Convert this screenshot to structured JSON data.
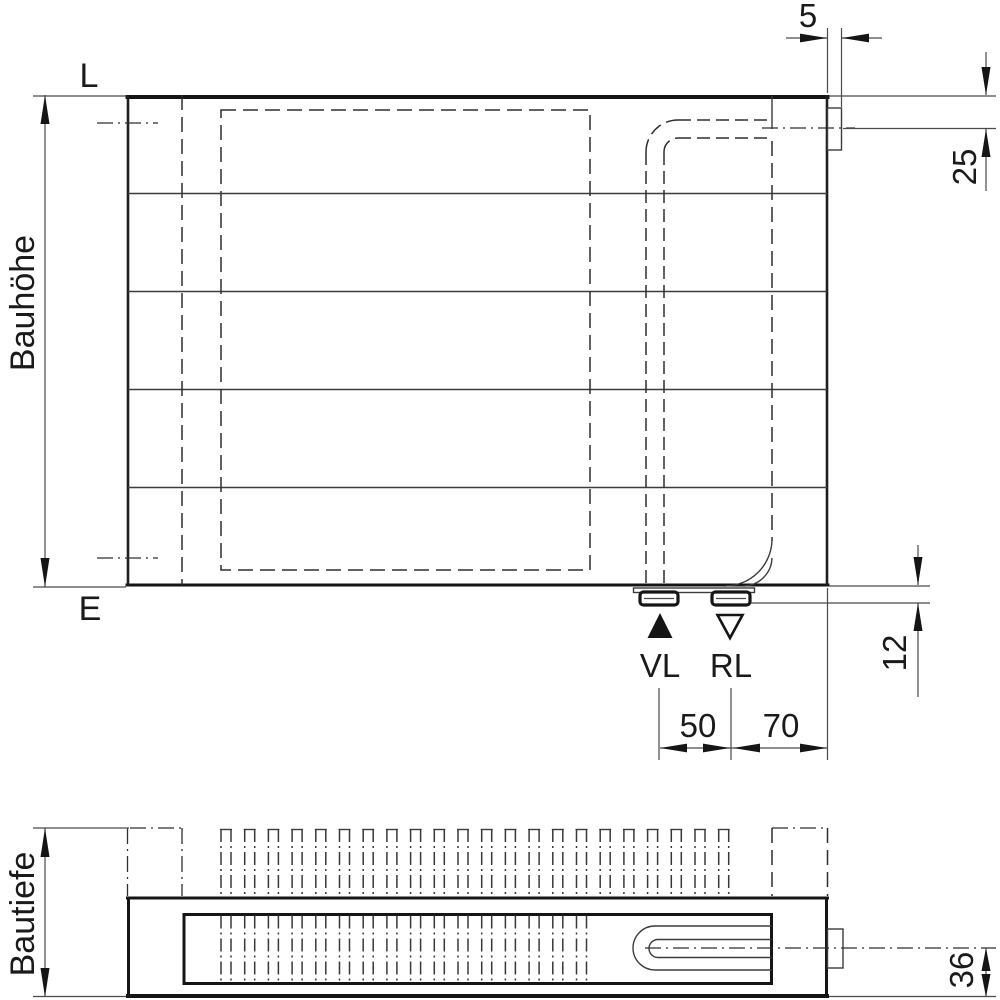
{
  "drawing_title": "Radiator technical drawing (front view and top view)",
  "labels": {
    "top_left": "L",
    "bottom_left": "E",
    "supply": "VL",
    "return": "RL",
    "height": "Bauhöhe",
    "depth": "Bautiefe"
  },
  "dims": {
    "tab_width": "5",
    "valve_center_offset": "25",
    "stub_protrusion": "12",
    "vl_rl_spacing": "50",
    "rl_to_edge": "70",
    "pipe_center_depth": "36"
  },
  "colors": {
    "line": "#151515",
    "thin_line": "#3c3c3c",
    "background": "#ffffff"
  }
}
